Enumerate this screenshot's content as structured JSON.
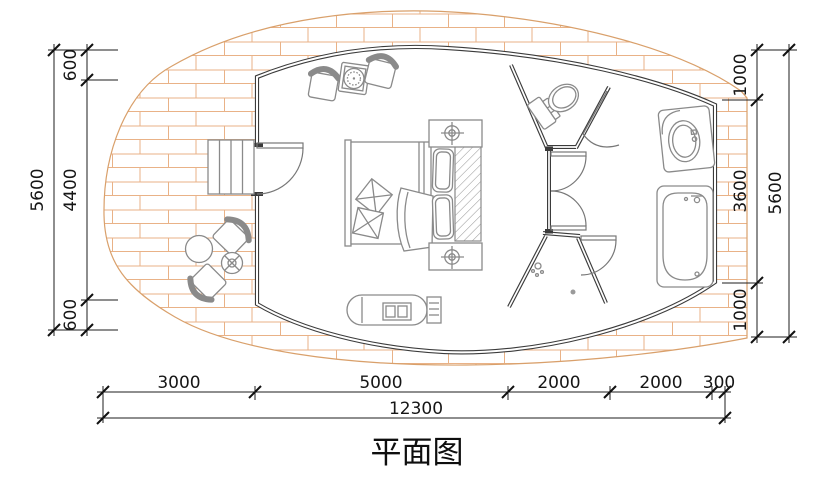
{
  "title": "平面图",
  "colors": {
    "deck_hatch": "#e9b287",
    "deck_outline": "#d9a06b",
    "wall": "#3b3b3b",
    "furniture_line": "#8a8a8a",
    "dimension_line": "#1c1c1c",
    "background": "#ffffff"
  },
  "dimensions": {
    "left": {
      "total": "5600",
      "segments": [
        "600",
        "4400",
        "600"
      ]
    },
    "right": {
      "total": "5600",
      "segments": [
        "1000",
        "3600",
        "1000"
      ]
    },
    "bottom": {
      "total": "12300",
      "segments": [
        "3000",
        "5000",
        "2000",
        "2000",
        "300"
      ]
    }
  }
}
